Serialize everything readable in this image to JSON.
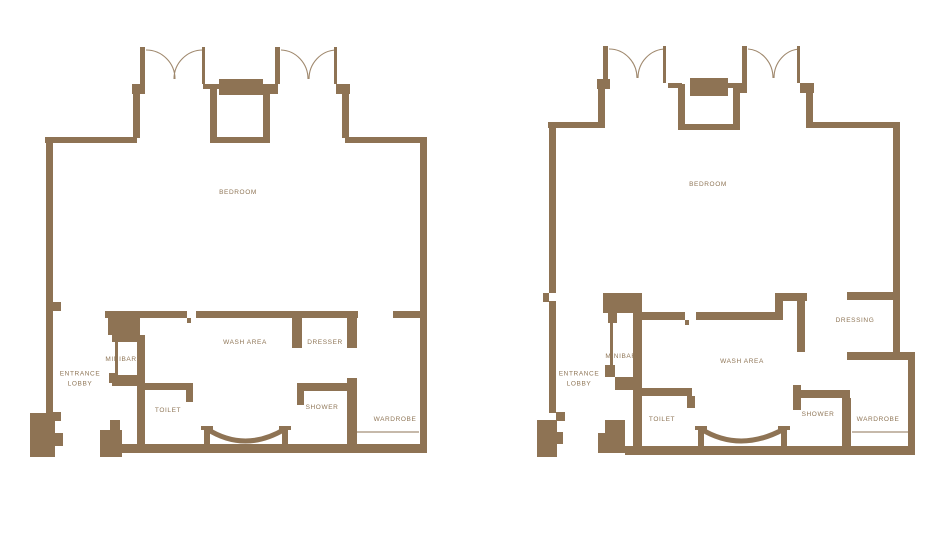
{
  "colors": {
    "wall": "#8e7354",
    "text": "#8f7657",
    "background": "#ffffff"
  },
  "plans": [
    {
      "name": "plan-left",
      "rooms": {
        "bedroom": "BEDROOM",
        "wash_area": "WASH AREA",
        "dresser": "DRESSER",
        "minibar": "MINIBAR",
        "entrance_lobby": "ENTRANCE\nLOBBY",
        "toilet": "TOILET",
        "shower": "SHOWER",
        "wardrobe": "WARDROBE"
      }
    },
    {
      "name": "plan-right",
      "rooms": {
        "bedroom": "BEDROOM",
        "wash_area": "WASH AREA",
        "dressing": "DRESSING",
        "minibar": "MINIBAR",
        "entrance_lobby": "ENTRANCE\nLOBBY",
        "toilet": "TOILET",
        "shower": "SHOWER",
        "wardrobe": "WARDROBE"
      }
    }
  ]
}
